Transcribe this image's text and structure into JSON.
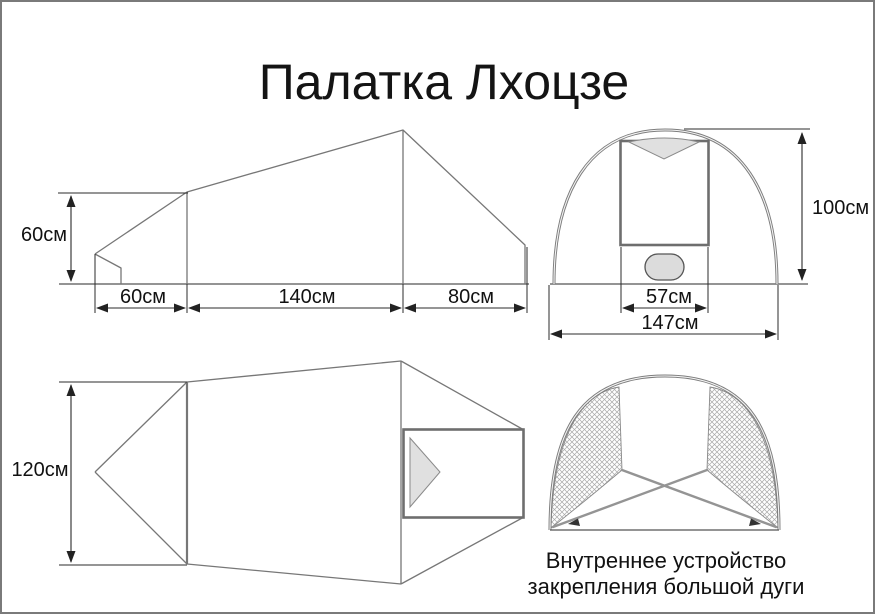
{
  "title": "Палатка Лхоцзе",
  "views": {
    "side": {
      "label_height": "60см",
      "label_front": "60см",
      "label_middle": "140см",
      "label_rear": "80см"
    },
    "front": {
      "label_door_width": "57см",
      "label_total_width": "147см",
      "label_height": "100см"
    },
    "top": {
      "label_width": "120см"
    },
    "inner": {
      "caption_line1": "Внутреннее устройство",
      "caption_line2": "закрепления большой дуги"
    }
  },
  "colors": {
    "background": "#ffffff",
    "page_border": "#7a7a7a",
    "tent_outline": "#777777",
    "dimension_lines": "#2b2b2b",
    "thick_frame": "#6e6e6e",
    "arc_pole": "#7d7d7d",
    "shaded_fill": "#e0e0e0",
    "strap": "#949494",
    "text": "#111111"
  }
}
